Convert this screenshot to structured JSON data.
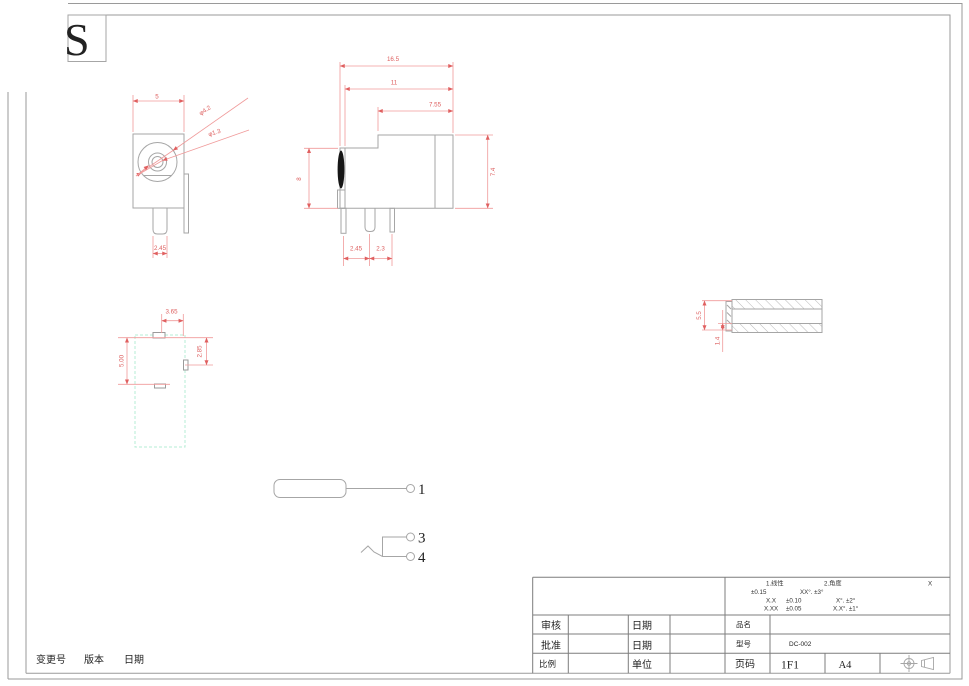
{
  "overlay": {
    "letter": "S"
  },
  "front_view": {
    "width": "5",
    "pin_width": "2.45",
    "outer_dia": "φ4.2",
    "inner_dia": "φ1.3"
  },
  "side_view": {
    "total_len": "16.5",
    "len11": "11",
    "len755": "7.55",
    "height": "8",
    "height74": "7.4",
    "pitch1": "2.45",
    "pitch2": "2.3"
  },
  "bottom_view": {
    "top": "3.65",
    "left": "5.00",
    "right": "2.85"
  },
  "pin_part": {
    "outer": "5.5",
    "wall": "1.4"
  },
  "callouts": {
    "n1": "1",
    "n3": "3",
    "n4": "4"
  },
  "revision": {
    "change_no": "变更号",
    "version": "版本",
    "date": "日期"
  },
  "title_block": {
    "tol": {
      "lin_label": "1.线性",
      "ang_label": "2.角度",
      "x": "X",
      "r1a": "±0.15",
      "r1b": "XX°. ±3°",
      "r2a": "X.X",
      "r2b": "±0.10",
      "r2c": "X°. ±2°",
      "r3a": "X.XX",
      "r3b": "±0.05",
      "r3c": "X.X°. ±1°"
    },
    "review": "审核",
    "approve": "批准",
    "scale": "比例",
    "date1": "日期",
    "date2": "日期",
    "unit": "单位",
    "product_label": "品名",
    "model_label": "型号",
    "page_label": "页码",
    "model": "DC-002",
    "page": "1F1",
    "size": "A4"
  }
}
